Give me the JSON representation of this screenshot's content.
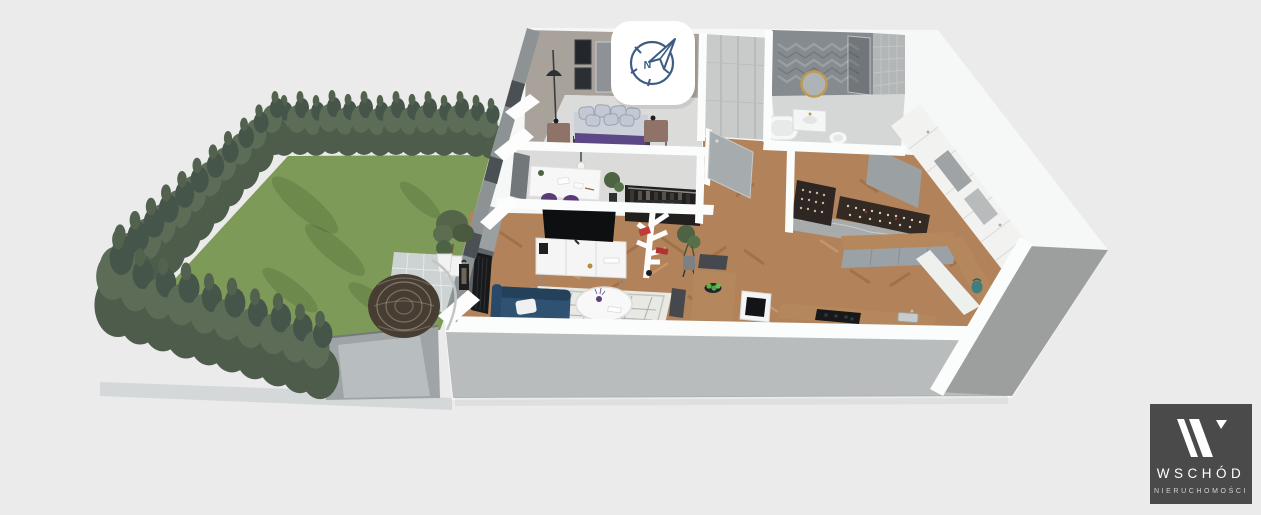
{
  "canvas": {
    "width": 1261,
    "height": 515,
    "background": "#ebebeb"
  },
  "compass": {
    "icon": "compass-north-icon",
    "north_label": "N",
    "stroke": "#3c5c84",
    "bg": "#ffffff"
  },
  "logo": {
    "monogram": "W",
    "brand": "WSCHÓD",
    "subtitle": "NIERUCHOMOŚCI",
    "bg": "#4a4a4b",
    "brand_color": "#ffffff",
    "subtitle_color": "#d2d2d2"
  },
  "colors": {
    "lawn": "#7d9a58",
    "hedge": "#4d5c4b",
    "hedge_light": "#5c6c56",
    "driveway": "#9fa5a7",
    "patio": "#cdd2d2",
    "curb": "#d5d8d8",
    "wall_white": "#f6f7f7",
    "wall_band": "#fbfcfc",
    "facade_gray": "#8d9294",
    "front_face": "#b9bcbc",
    "side_face": "#9c9f9d",
    "wood_floor": "#b2835a",
    "room_floor": "#dbdbd9",
    "bedroom_wall": "#a9a29b",
    "wardrobe_doors": "#c9cbca",
    "bath_wall": "#868b8f",
    "tile_wall": "#b2b6b6",
    "cabinet_white": "#f2f3f1",
    "counter_gray": "#9aa1a7",
    "sofa": "#2f5273",
    "bed_platform": "#433d46",
    "bed_throw": "#5c4787",
    "duvet": "#ccd0d8",
    "pillow": "#c3c9d4",
    "rug": "#e8e9e5",
    "tv": "#0e0f11",
    "table_wood": "#b5875c",
    "chair_gray": "#45494d",
    "apples": "#58b44b",
    "shelf_red": "#c03a36",
    "kettle": "#3e7d80",
    "rack_dark": "#2e2622",
    "plant_green": "#4d6344",
    "egg_chair": "#473d33"
  },
  "scene": {
    "type": "3d-isometric-floor-plan",
    "areas": [
      "garden",
      "patio",
      "driveway",
      "bedroom",
      "office-nook",
      "wardrobe",
      "bathroom",
      "hallway",
      "kitchen",
      "living-room",
      "dining-area",
      "entry"
    ]
  }
}
